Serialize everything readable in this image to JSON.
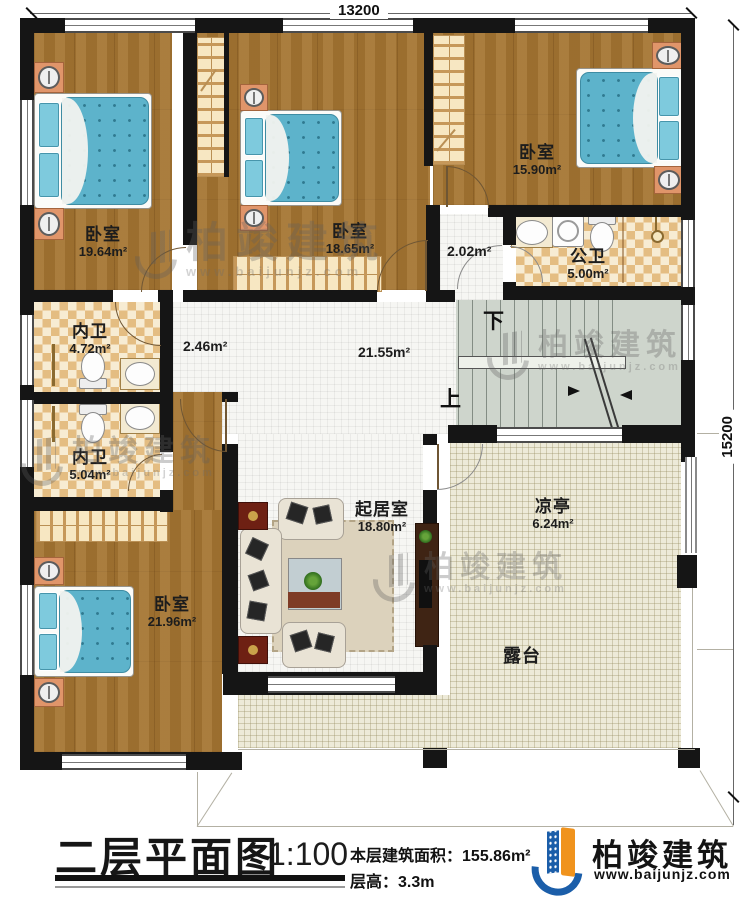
{
  "dimensions": {
    "width_label": "13200",
    "height_label": "15200"
  },
  "rooms": {
    "bedroom_tl": {
      "name": "卧室",
      "area": "19.64m²"
    },
    "bedroom_tm": {
      "name": "卧室",
      "area": "18.65m²"
    },
    "bedroom_tr": {
      "name": "卧室",
      "area": "15.90m²"
    },
    "public_bath": {
      "name": "公卫",
      "area": "5.00m²"
    },
    "bath_upper": {
      "name": "内卫",
      "area": "4.72m²"
    },
    "bath_lower": {
      "name": "内卫",
      "area": "5.04m²"
    },
    "bedroom_bl": {
      "name": "卧室",
      "area": "21.96m²"
    },
    "living": {
      "name": "起居室",
      "area": "18.80m²"
    },
    "pavilion": {
      "name": "凉亭",
      "area": "6.24m²"
    },
    "terrace": {
      "name": "露台"
    },
    "hall_area": "21.55m²",
    "corridor_left_area": "2.46m²",
    "corridor_top_area": "2.02m²"
  },
  "stairs": {
    "down_label": "下",
    "up_label": "上"
  },
  "title_block": {
    "title": "二层平面图",
    "scale": "1:100",
    "area_label": "本层建筑面积：",
    "area_value": "155.86m²",
    "height_label": "层高：",
    "height_value": "3.3m"
  },
  "brand": {
    "name": "柏竣建筑",
    "website": "www.baijunjz.com"
  }
}
